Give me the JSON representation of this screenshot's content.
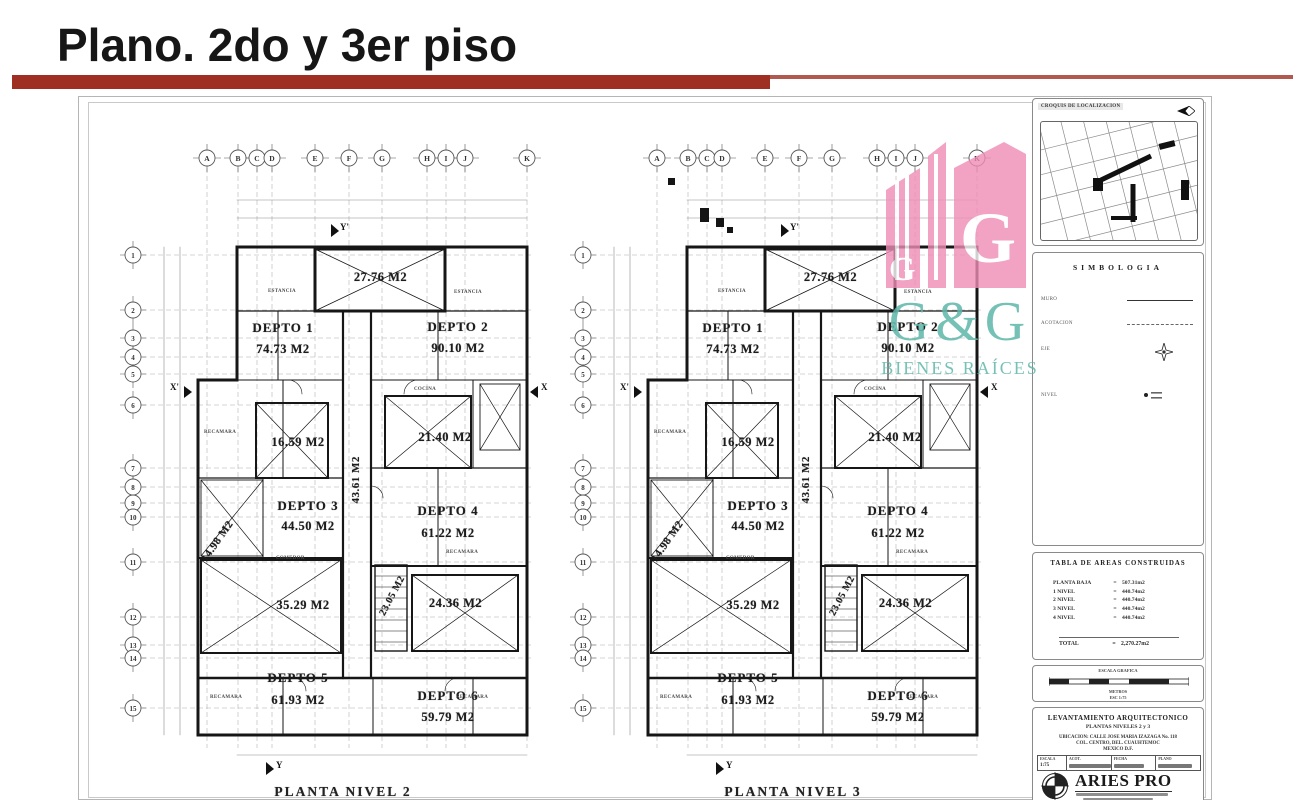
{
  "title": "Plano. 2do y 3er piso",
  "colors": {
    "accent": "#9e2f22",
    "pink": "#ef8db5",
    "teal": "#5fb7aa"
  },
  "watermark": {
    "gg": "G&G",
    "sub": "BIENES RAÍCES",
    "logo_g_big": "G",
    "logo_g_small": "G"
  },
  "plans": [
    {
      "caption": "PLANTA NIVEL 2",
      "grid_letters": [
        "A",
        "B",
        "C",
        "D",
        "E",
        "F",
        "G",
        "H",
        "I",
        "J",
        "K"
      ],
      "row_numbers": [
        "1",
        "2",
        "3",
        "4",
        "5",
        "6",
        "7",
        "8",
        "9",
        "10",
        "11",
        "12",
        "13",
        "14",
        "15"
      ],
      "markers": {
        "x_left": "X'",
        "x_right": "X",
        "y_top": "Y'",
        "y_bottom": "Y"
      },
      "deptos": [
        {
          "name": "DEPTO 1",
          "area": "74.73 M2"
        },
        {
          "name": "DEPTO 2",
          "area": "90.10 M2"
        },
        {
          "name": "DEPTO 3",
          "area": "44.50 M2"
        },
        {
          "name": "DEPTO 4",
          "area": "61.22 M2"
        },
        {
          "name": "DEPTO 5",
          "area": "61.93 M2"
        },
        {
          "name": "DEPTO 6",
          "area": "59.79 M2"
        }
      ],
      "areas": {
        "patio_top": "27.76 M2",
        "patio_mid_left": "16.59 M2",
        "patio_mid_right": "21.40 M2",
        "corridor": "43.61 M2",
        "left_diag": "14.98 M2",
        "patio_low_left": "35.29 M2",
        "stair_diag": "23.05 M2",
        "patio_low_right": "24.36 M2"
      },
      "rooms": [
        "ESTANCIA",
        "ESTANCIA",
        "RECAMARA",
        "COCINA",
        "COMEDOR",
        "RECAMARA",
        "RECAMARA",
        "RECAMARA"
      ]
    },
    {
      "caption": "PLANTA NIVEL 3",
      "grid_letters": [
        "A",
        "B",
        "C",
        "D",
        "E",
        "F",
        "G",
        "H",
        "I",
        "J",
        "K"
      ],
      "row_numbers": [
        "1",
        "2",
        "3",
        "4",
        "5",
        "6",
        "7",
        "8",
        "9",
        "10",
        "11",
        "12",
        "13",
        "14",
        "15"
      ],
      "markers": {
        "x_left": "X'",
        "x_right": "X",
        "y_top": "Y'",
        "y_bottom": "Y"
      },
      "deptos": [
        {
          "name": "DEPTO 1",
          "area": "74.73 M2"
        },
        {
          "name": "DEPTO 2",
          "area": "90.10 M2"
        },
        {
          "name": "DEPTO 3",
          "area": "44.50 M2"
        },
        {
          "name": "DEPTO 4",
          "area": "61.22 M2"
        },
        {
          "name": "DEPTO 5",
          "area": "61.93 M2"
        },
        {
          "name": "DEPTO 6",
          "area": "59.79 M2"
        }
      ],
      "areas": {
        "patio_top": "27.76 M2",
        "patio_mid_left": "16.59 M2",
        "patio_mid_right": "21.40 M2",
        "corridor": "43.61 M2",
        "left_diag": "14.98 M2",
        "patio_low_left": "35.29 M2",
        "stair_diag": "23.05 M2",
        "patio_low_right": "24.36 M2"
      },
      "rooms": [
        "ESTANCIA",
        "ESTANCIA",
        "RECAMARA",
        "COCINA",
        "COMEDOR",
        "RECAMARA",
        "RECAMARA",
        "RECAMARA"
      ]
    }
  ],
  "sidebar": {
    "croquis": {
      "title": "CROQUIS DE LOCALIZACION"
    },
    "simbologia": {
      "title": "SIMBOLOGIA",
      "items": [
        "MURO",
        "ACOTACION",
        "EJE",
        "NIVEL"
      ]
    },
    "tabla": {
      "title": "TABLA DE AREAS CONSTRUIDAS",
      "rows": [
        {
          "label": "PLANTA BAJA",
          "eq": "=",
          "value": "507.31m2"
        },
        {
          "label": "1 NIVEL",
          "eq": "=",
          "value": "440.74m2"
        },
        {
          "label": "2 NIVEL",
          "eq": "=",
          "value": "440.74m2"
        },
        {
          "label": "3 NIVEL",
          "eq": "=",
          "value": "440.74m2"
        },
        {
          "label": "4 NIVEL",
          "eq": "=",
          "value": "440.74m2"
        }
      ],
      "total_label": "TOTAL",
      "total_eq": "=",
      "total_value": "2,270.27m2"
    },
    "escala": {
      "title": "ESCALA GRAFICA",
      "line1": "METROS",
      "line2": "ESC 1:75"
    },
    "titleblock": {
      "line1": "LEVANTAMIENTO ARQUITECTONICO",
      "line2": "PLANTAS NIVELES 2 y 3",
      "line3": "UBICACION: CALLE JOSE MARIA IZAZAGA No. 118",
      "line4": "COL. CENTRO, DEL. CUAUHTEMOC",
      "line5": "MEXICO D.F.",
      "fields": [
        {
          "label": "ESCALA",
          "value": "1:75"
        },
        {
          "label": "ACOT."
        },
        {
          "label": "FECHA"
        },
        {
          "label": "PLANO"
        }
      ],
      "company": "ARIES PRO"
    }
  }
}
